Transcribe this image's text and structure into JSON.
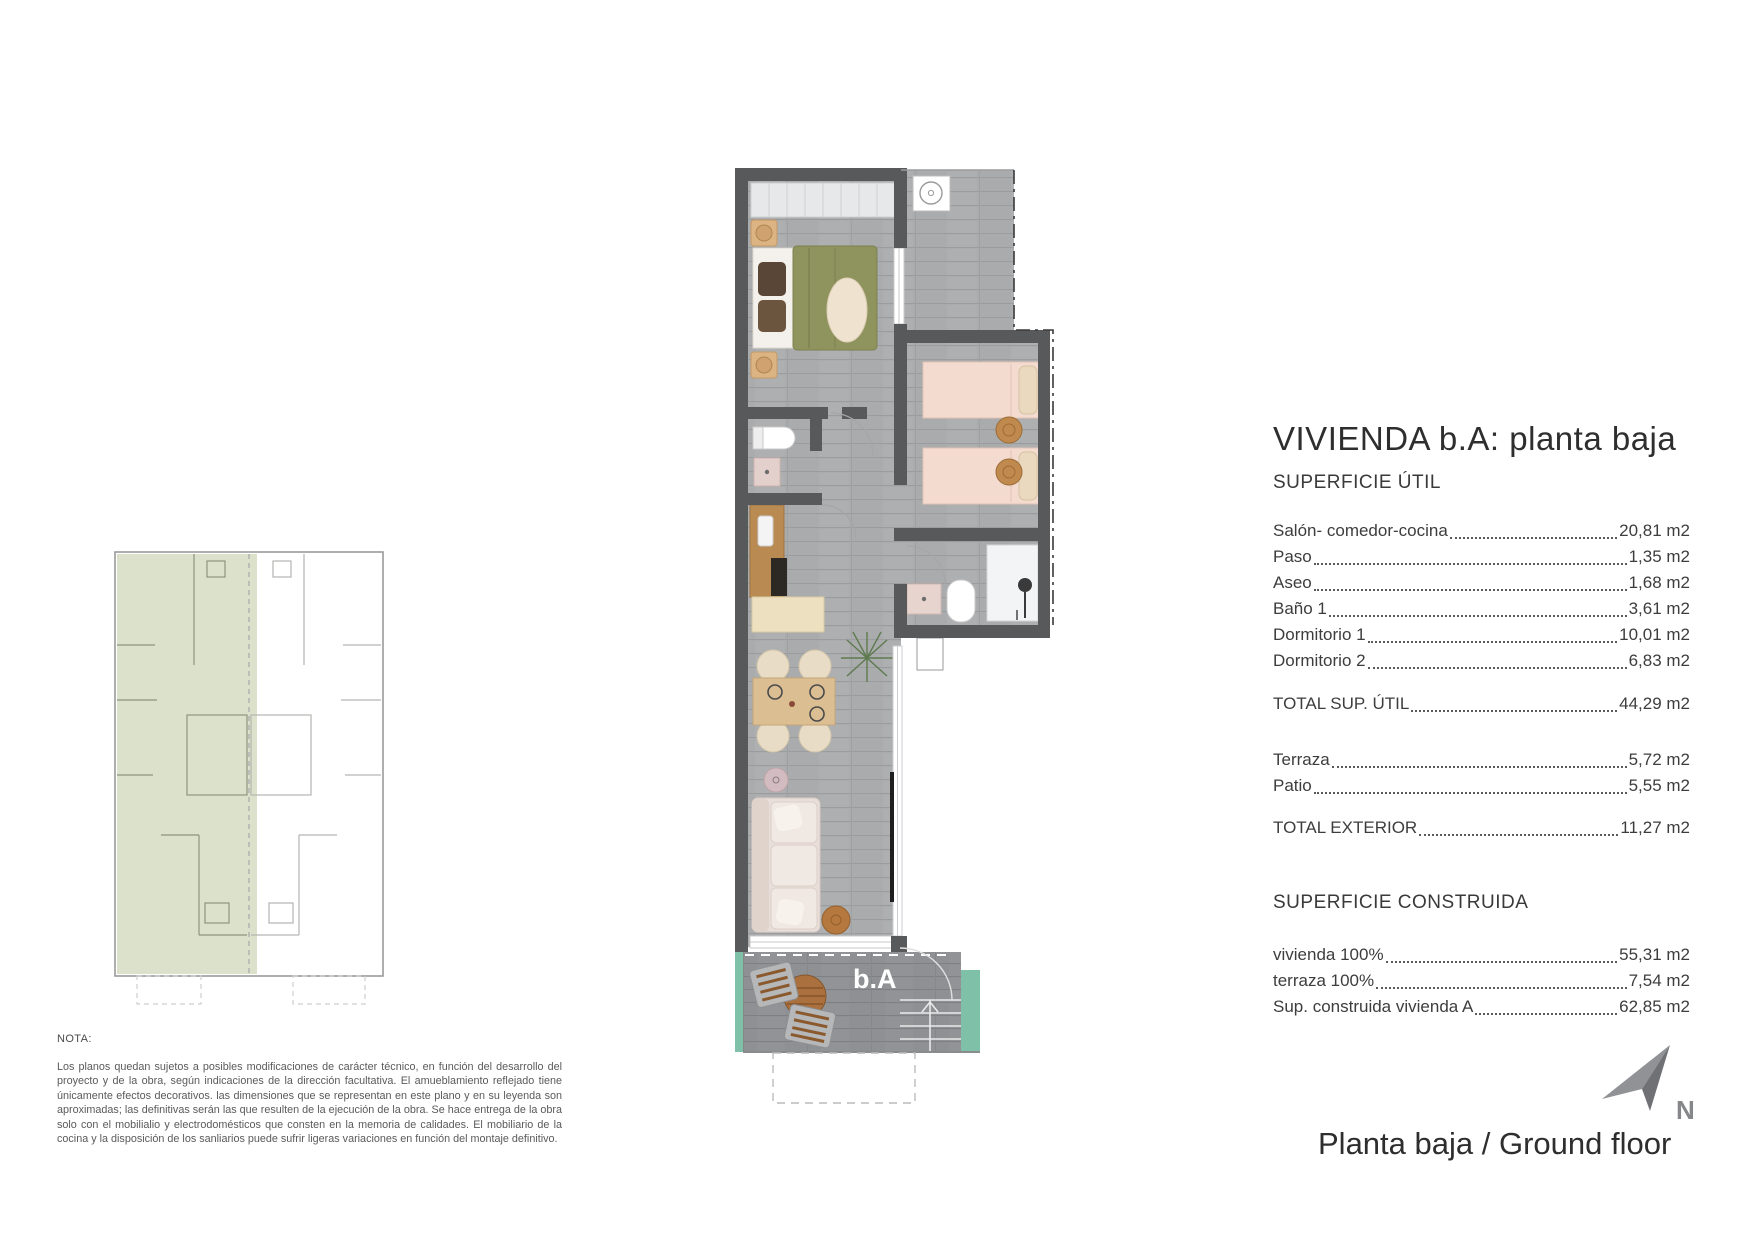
{
  "title": "VIVIENDA b.A: planta baja",
  "superficie_util": {
    "heading": "SUPERFICIE ÚTIL",
    "rows": [
      {
        "label": "Salón- comedor-cocina",
        "value": "20,81 m2"
      },
      {
        "label": "Paso",
        "value": "1,35 m2"
      },
      {
        "label": "Aseo",
        "value": "1,68 m2"
      },
      {
        "label": "Baño 1",
        "value": "3,61 m2"
      },
      {
        "label": "Dormitorio 1",
        "value": "10,01 m2"
      },
      {
        "label": "Dormitorio 2",
        "value": "6,83 m2"
      }
    ],
    "total": {
      "label": "TOTAL SUP. ÚTIL",
      "value": "44,29 m2"
    },
    "exterior_rows": [
      {
        "label": "Terraza",
        "value": "5,72 m2"
      },
      {
        "label": "Patio",
        "value": "5,55 m2"
      }
    ],
    "total_exterior": {
      "label": "TOTAL EXTERIOR",
      "value": "11,27 m2"
    }
  },
  "superficie_construida": {
    "heading": "SUPERFICIE CONSTRUIDA",
    "rows": [
      {
        "label": "vivienda 100%",
        "value": "55,31 m2"
      },
      {
        "label": "terraza 100%",
        "value": "7,54 m2"
      },
      {
        "label": "Sup. construida vivienda A",
        "value": "62,85 m2"
      }
    ]
  },
  "nota": {
    "heading": "NOTA:",
    "body": "Los planos quedan sujetos a posibles modificaciones de carácter técnico, en función del desarrollo del proyecto y de la obra, según indicaciones de la dirección facultativa. El amueblamiento reflejado tiene únicamente efectos decorativos. las dimensiones que se representan en este plano y en su leyenda son aproximadas; las definitivas serán las que resulten de la ejecución de la obra. Se hace entrega de la obra solo con el mobilialio y electrodomésticos que consten en la memoria de calidades. El mobiliario de la cocina y la disposición de los sanliarios puede sufrir ligeras variaciones en función del montaje definitivo."
  },
  "footer": {
    "floor_label": "Planta baja / Ground floor",
    "north_label": "N"
  },
  "plan": {
    "unit_label": "b.A"
  },
  "colors": {
    "wall": "#58595b",
    "floor": "#aaabad",
    "terrace_floor": "#8f9093",
    "keyplan_highlight": "#dbe1ca",
    "teal_accent": "#7fc0a9",
    "duvet_olive": "#8f945e",
    "bed_pink": "#f3dbd0",
    "wood": "#b98a52",
    "north_gray": "#85878a"
  }
}
